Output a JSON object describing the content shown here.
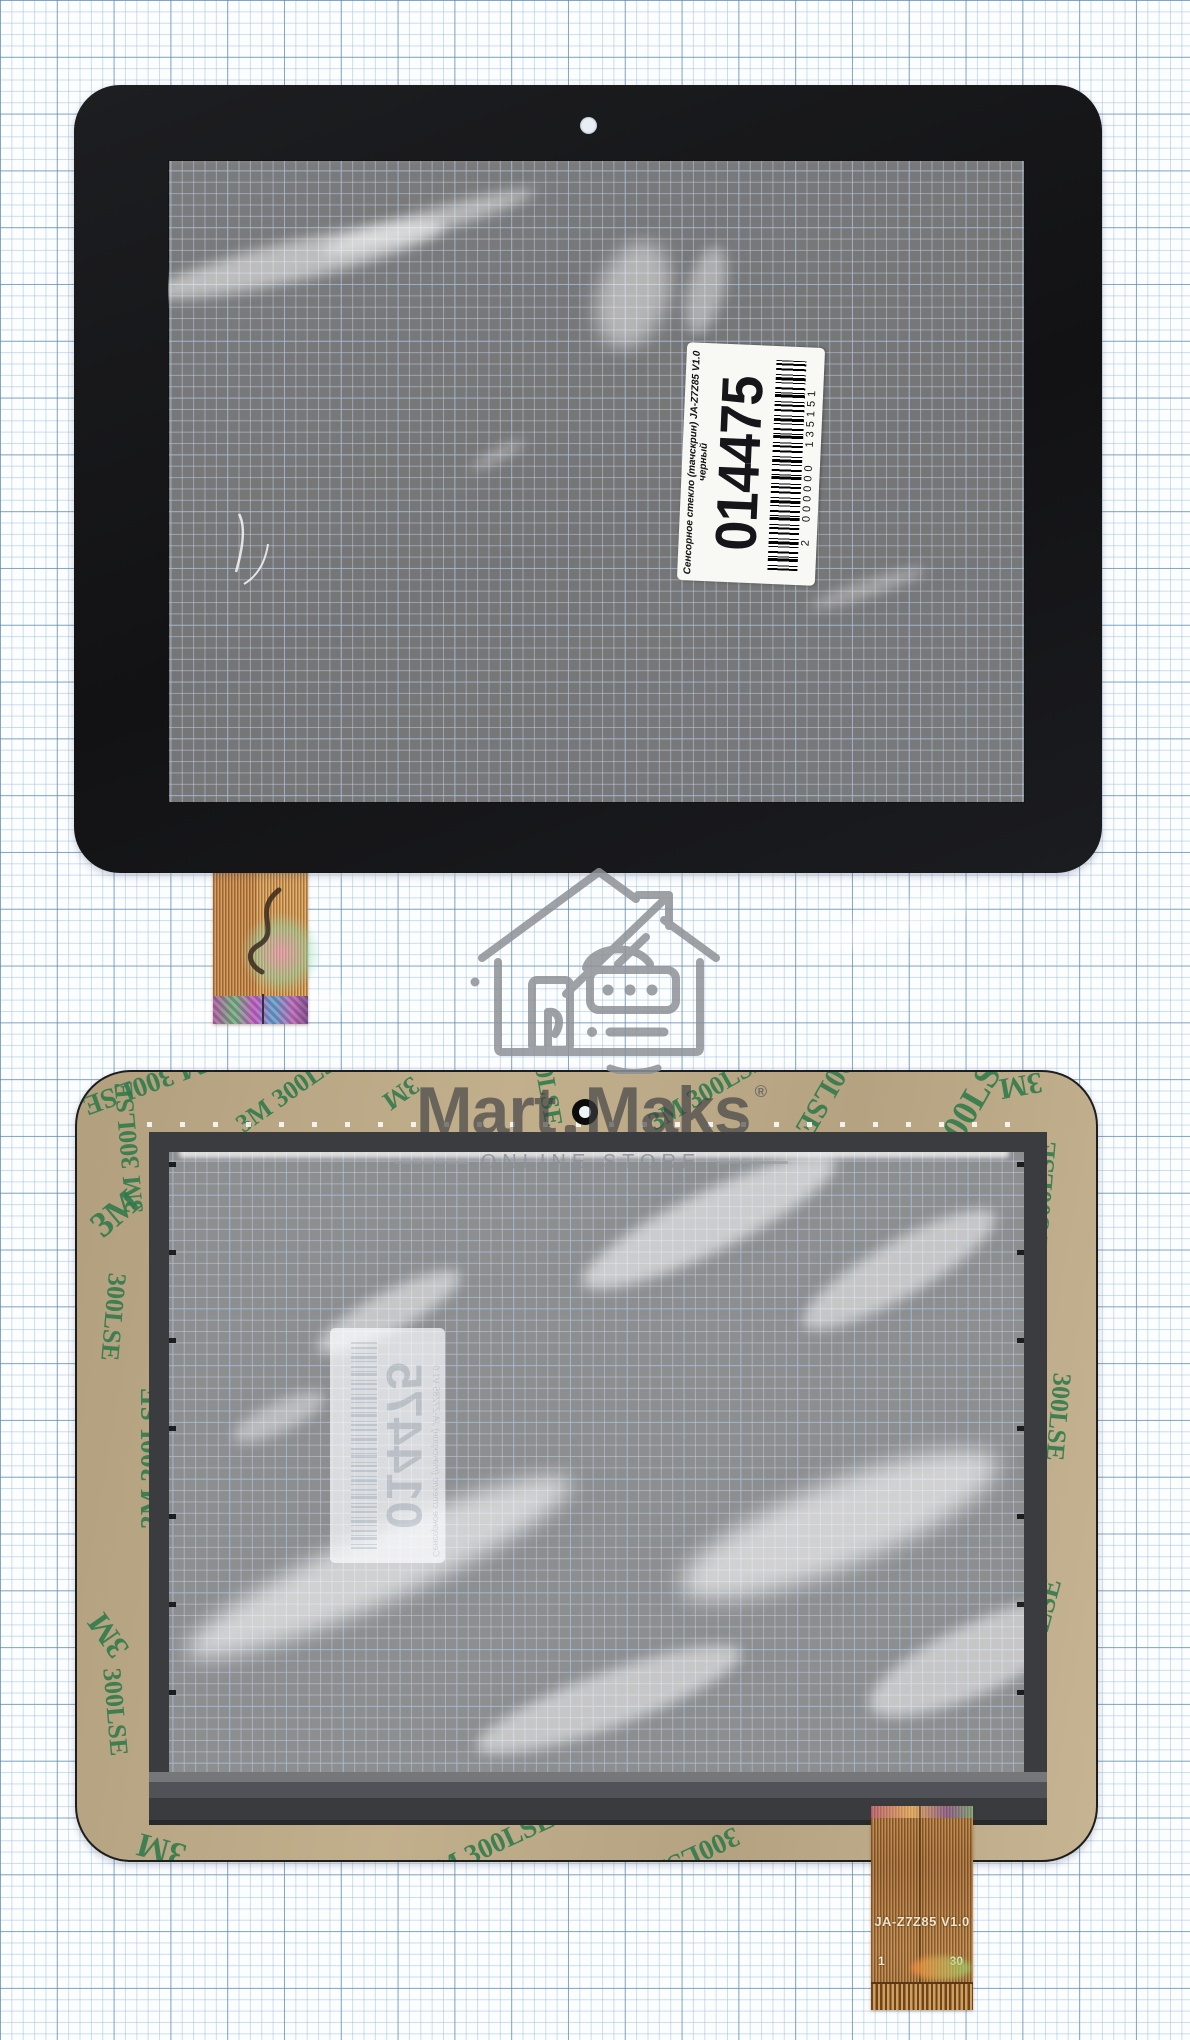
{
  "watermark": {
    "brand_first": "Mart",
    "brand_second": "Maks",
    "registered": "®",
    "tagline": "ONLINE STORE"
  },
  "sticker": {
    "title": "Сенсорное стекло (тачскрин) JA-Z7Z85 V1.0",
    "color_note": "черный",
    "number": "014475",
    "barcode_text": "2 000000 135151"
  },
  "adhesive": {
    "print": "3M 300LSE",
    "brand": "3M",
    "code": "300LSE"
  },
  "flex_cable": {
    "model": "JA-Z7Z85 V1.0",
    "pin_first": "1",
    "pin_last": "30"
  },
  "colors": {
    "paper_grid_major": "#5682ad",
    "paper_grid_minor": "#98bcda",
    "panel_black": "#17181b",
    "adhesive_tape": "#b9a583",
    "adhesive_print_green": "#2e7a4b",
    "sensor_frame_gray": "#3b3c40",
    "copper_cable": "#c89052",
    "watermark_gray": "#3c3e43"
  }
}
